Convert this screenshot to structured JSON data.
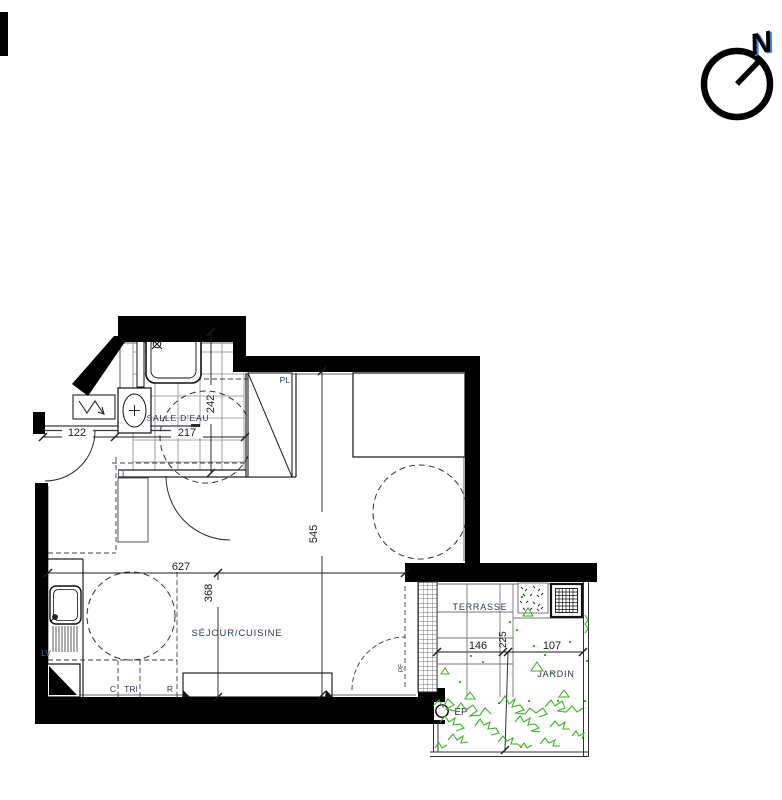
{
  "title": "apartment-floor-plan",
  "compass": {
    "north_label": "N"
  },
  "rooms": {
    "bathroom": "SALLE D'EAU",
    "living": "SÉJOUR/CUISINE",
    "terrace": "TERRASSE",
    "garden": "JARDIN"
  },
  "fixtures": {
    "closet": "PL",
    "washer": "LL",
    "dishwasher": "LV",
    "cooker": "C",
    "sorting": "TRI",
    "fridge": "R",
    "rainwater": "EP",
    "french_door": "PF"
  },
  "dimensions": {
    "entry_width": "122",
    "bathroom_width": "217",
    "bathroom_depth": "242",
    "living_height": "545",
    "living_width": "627",
    "kitchen_depth": "368",
    "terrace_width": "146",
    "terrace_depth": "225",
    "garden_width": "107"
  },
  "colors": {
    "wall": "#000000",
    "vegetation": "#3fae2a",
    "label": "#2f3b4c",
    "dimension": "#1c1c1c",
    "north_blue": "#3f7fd6"
  }
}
